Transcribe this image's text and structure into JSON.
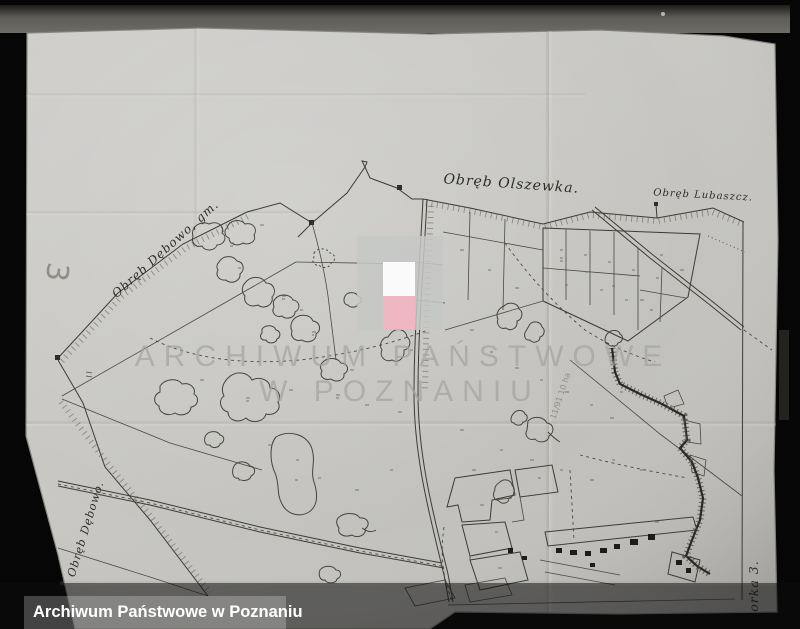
{
  "archive_bar": {
    "label": "Archiwum Państwowe w Poznaniu"
  },
  "watermark": {
    "line1": "ARCHIWUM PAŃSTWOWE",
    "line2": "W POZNANIU"
  },
  "map_labels": {
    "olszewka": "Obręb Olszewka.",
    "lubaszcz": "Obręb Lubaszcz.",
    "debowo_gm": "Obręb Dębowo, gm.",
    "debowo": "Obręb Dębowo.",
    "sheet_number": "3",
    "corner_note": "orka 3.",
    "pencil_note": "11/91 10 ha"
  },
  "colors": {
    "paper": "#c7c6c2",
    "ink": "#3c3c37",
    "flag_white": "#fafafa",
    "flag_pink": "#efb7c1",
    "watermark_gray": "#a2a2a0",
    "photo_border": "#060606"
  }
}
